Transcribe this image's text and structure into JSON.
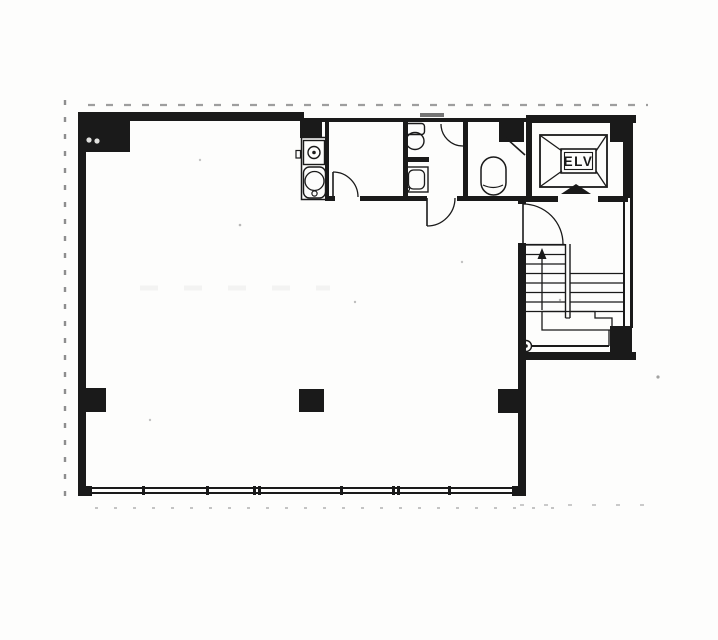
{
  "meta": {
    "ink": "#1a1a1a",
    "paper": "#fdfdfc",
    "description": "scanned-building-floor-plan"
  },
  "elevator": {
    "label": "ELV"
  },
  "plan": {
    "elements": [
      {
        "kind": "frect",
        "name": "wall-top-main",
        "x": 78,
        "y": 112,
        "w": 226,
        "h": 9
      },
      {
        "kind": "frect",
        "name": "wall-top-service",
        "x": 302,
        "y": 118,
        "w": 230,
        "h": 4
      },
      {
        "kind": "frect",
        "name": "window-mark-top",
        "x": 420,
        "y": 113,
        "w": 24,
        "h": 4,
        "opacity": 0.6
      },
      {
        "kind": "frect",
        "name": "wall-top-wing",
        "x": 526,
        "y": 115,
        "w": 110,
        "h": 8
      },
      {
        "kind": "frect",
        "name": "wall-left",
        "x": 78,
        "y": 112,
        "w": 8,
        "h": 384
      },
      {
        "kind": "frect",
        "name": "wall-east-main-stub",
        "x": 518,
        "y": 196,
        "w": 8,
        "h": 8
      },
      {
        "kind": "frect",
        "name": "wall-east-main",
        "x": 518,
        "y": 243,
        "w": 8,
        "h": 247
      },
      {
        "kind": "frect",
        "name": "wall-service-bottom-a",
        "x": 325,
        "y": 196,
        "w": 10,
        "h": 5
      },
      {
        "kind": "frect",
        "name": "wall-service-bottom-b",
        "x": 360,
        "y": 196,
        "w": 67,
        "h": 5
      },
      {
        "kind": "frect",
        "name": "wall-service-bottom-c",
        "x": 457,
        "y": 196,
        "w": 69,
        "h": 5
      },
      {
        "kind": "frect",
        "name": "wall-room1-west",
        "x": 325,
        "y": 120,
        "w": 4,
        "h": 78
      },
      {
        "kind": "frect",
        "name": "wall-room1-east",
        "x": 403,
        "y": 120,
        "w": 5,
        "h": 80
      },
      {
        "kind": "frect",
        "name": "wall-wc-divider",
        "x": 463,
        "y": 120,
        "w": 5,
        "h": 76
      },
      {
        "kind": "frect",
        "name": "wall-wc1-partition",
        "x": 403,
        "y": 157,
        "w": 26,
        "h": 5
      },
      {
        "kind": "frect",
        "name": "wall-wing-west",
        "x": 526,
        "y": 120,
        "w": 6,
        "h": 82
      },
      {
        "kind": "frect",
        "name": "wall-elv-bottom-west",
        "x": 526,
        "y": 196,
        "w": 32,
        "h": 6
      },
      {
        "kind": "frect",
        "name": "wall-elv-bottom-east",
        "x": 598,
        "y": 196,
        "w": 30,
        "h": 6
      },
      {
        "kind": "frect",
        "name": "wall-wing-east-upper",
        "x": 623,
        "y": 120,
        "w": 10,
        "h": 78
      },
      {
        "kind": "frect",
        "name": "wall-wing-east-line1",
        "x": 623,
        "y": 198,
        "w": 2,
        "h": 130
      },
      {
        "kind": "frect",
        "name": "wall-wing-east-line2",
        "x": 630,
        "y": 198,
        "w": 3,
        "h": 130
      },
      {
        "kind": "frect",
        "name": "wall-wing-bottom",
        "x": 518,
        "y": 352,
        "w": 118,
        "h": 8
      },
      {
        "kind": "frect",
        "name": "window-sill-top",
        "x": 86,
        "y": 487,
        "w": 432,
        "h": 2
      },
      {
        "kind": "frect",
        "name": "window-sill-bottom",
        "x": 86,
        "y": 492,
        "w": 432,
        "h": 2
      },
      {
        "kind": "frect",
        "name": "corner-block-sw",
        "x": 78,
        "y": 486,
        "w": 14,
        "h": 10
      },
      {
        "kind": "frect",
        "name": "corner-block-se",
        "x": 512,
        "y": 486,
        "w": 14,
        "h": 10
      },
      {
        "kind": "frect",
        "name": "column-nw",
        "x": 86,
        "y": 118,
        "w": 44,
        "h": 34
      },
      {
        "kind": "frect",
        "name": "column-n-kitchen",
        "x": 300,
        "y": 120,
        "w": 22,
        "h": 18
      },
      {
        "kind": "frect",
        "name": "column-n-wc",
        "x": 499,
        "y": 120,
        "w": 25,
        "h": 22
      },
      {
        "kind": "frect",
        "name": "column-ne",
        "x": 610,
        "y": 118,
        "w": 22,
        "h": 24
      },
      {
        "kind": "frect",
        "name": "column-west-wall",
        "x": 86,
        "y": 388,
        "w": 20,
        "h": 24
      },
      {
        "kind": "frect",
        "name": "column-center",
        "x": 299,
        "y": 389,
        "w": 25,
        "h": 23
      },
      {
        "kind": "frect",
        "name": "column-east-wall",
        "x": 498,
        "y": 389,
        "w": 20,
        "h": 24
      },
      {
        "kind": "frect",
        "name": "column-se-wing",
        "x": 610,
        "y": 326,
        "w": 22,
        "h": 28
      },
      {
        "kind": "frect",
        "name": "window-mullion-1",
        "x": 142,
        "y": 486,
        "w": 3,
        "h": 9
      },
      {
        "kind": "frect",
        "name": "window-mullion-2",
        "x": 206,
        "y": 486,
        "w": 3,
        "h": 9
      },
      {
        "kind": "frect",
        "name": "window-mullion-3",
        "x": 253,
        "y": 486,
        "w": 3,
        "h": 9
      },
      {
        "kind": "frect",
        "name": "window-mullion-4",
        "x": 258,
        "y": 486,
        "w": 3,
        "h": 9
      },
      {
        "kind": "frect",
        "name": "window-mullion-5",
        "x": 340,
        "y": 486,
        "w": 3,
        "h": 9
      },
      {
        "kind": "frect",
        "name": "window-mullion-6",
        "x": 392,
        "y": 486,
        "w": 3,
        "h": 9
      },
      {
        "kind": "frect",
        "name": "window-mullion-7",
        "x": 397,
        "y": 486,
        "w": 3,
        "h": 9
      },
      {
        "kind": "frect",
        "name": "window-mullion-8",
        "x": 448,
        "y": 486,
        "w": 3,
        "h": 9
      },
      {
        "kind": "srect",
        "name": "kitchen-unit-outline",
        "x": 301.5,
        "y": 137.5,
        "w": 25,
        "h": 62,
        "sw": 1.5
      },
      {
        "kind": "srect",
        "name": "kitchen-sink-top",
        "x": 303.5,
        "y": 140.5,
        "w": 21,
        "h": 24,
        "sw": 1.4
      },
      {
        "kind": "circle",
        "name": "kitchen-sink-drain",
        "cx": 314,
        "cy": 152.5,
        "r": 6,
        "sw": 1.4
      },
      {
        "kind": "fcircle",
        "name": "kitchen-sink-dot",
        "cx": 314,
        "cy": 152.5,
        "r": 1.8
      },
      {
        "kind": "srect",
        "name": "kitchen-basin-outline",
        "x": 303.5,
        "y": 167,
        "w": 22,
        "h": 31,
        "rx": 6,
        "sw": 1.4
      },
      {
        "kind": "circle",
        "name": "kitchen-basin-bowl",
        "cx": 314.5,
        "cy": 181,
        "r": 9.5,
        "sw": 1.3
      },
      {
        "kind": "circle",
        "name": "kitchen-basin-drain",
        "cx": 314.5,
        "cy": 193.5,
        "r": 2.6,
        "sw": 1.2
      },
      {
        "kind": "srect",
        "name": "kitchen-knob",
        "x": 296,
        "y": 150.5,
        "w": 4.5,
        "h": 7.5,
        "sw": 1.2
      },
      {
        "kind": "path",
        "name": "room1-door-leaf",
        "d": "M333,172 L333,197",
        "sw": 1.6
      },
      {
        "kind": "path",
        "name": "room1-door-swing",
        "d": "M333,172 A25,25 0 0 1 358,197",
        "sw": 1.3
      },
      {
        "kind": "srect",
        "name": "wc1-toilet-tank",
        "x": 405.5,
        "y": 123.5,
        "w": 19,
        "h": 11,
        "rx": 3,
        "sw": 1.4
      },
      {
        "kind": "ellipse",
        "name": "wc1-toilet-bowl",
        "cx": 415,
        "cy": 141,
        "rx": 9,
        "ry": 8.5,
        "sw": 1.4
      },
      {
        "kind": "path",
        "name": "wc1-stall-door-swing",
        "d": "M441,124 A22,22 0 0 0 463,146",
        "sw": 1.3
      },
      {
        "kind": "srect",
        "name": "wc1-sink-outline",
        "x": 405,
        "y": 167,
        "w": 23,
        "h": 25,
        "sw": 1.4
      },
      {
        "kind": "srect",
        "name": "wc1-sink-basin",
        "x": 408.5,
        "y": 170,
        "w": 16,
        "h": 19,
        "rx": 5,
        "sw": 1.3
      },
      {
        "kind": "circle",
        "name": "wc1-sink-tap",
        "cx": 407.5,
        "cy": 189,
        "r": 2,
        "sw": 1.2
      },
      {
        "kind": "path",
        "name": "wc1-entry-door-leaf",
        "d": "M427,198 L427,226",
        "sw": 1.6
      },
      {
        "kind": "path",
        "name": "wc1-entry-door-swing",
        "d": "M427,226 A28,28 0 0 0 455,198",
        "sw": 1.3
      },
      {
        "kind": "srect",
        "name": "wc2-toilet",
        "x": 481,
        "y": 157,
        "w": 25,
        "h": 38,
        "rx": 12.5,
        "sw": 1.5
      },
      {
        "kind": "path",
        "name": "wc2-toilet-seatline",
        "d": "M483,185 Q493.5,190 503,185",
        "sw": 1.2
      },
      {
        "kind": "path",
        "name": "wc2-door-leaf",
        "d": "M506,138 L525,155",
        "sw": 1.6
      },
      {
        "kind": "srect",
        "name": "elevator-shaft",
        "x": 540,
        "y": 135,
        "w": 67,
        "h": 52,
        "sw": 1.8
      },
      {
        "kind": "path",
        "name": "elevator-cross-nw",
        "d": "M541,136 L562,151",
        "sw": 1.3
      },
      {
        "kind": "path",
        "name": "elevator-cross-ne",
        "d": "M606,136 L596,151",
        "sw": 1.3
      },
      {
        "kind": "path",
        "name": "elevator-cross-sw",
        "d": "M541,186 L562,171",
        "sw": 1.3
      },
      {
        "kind": "path",
        "name": "elevator-cross-se",
        "d": "M606,186 L596,171",
        "sw": 1.3
      },
      {
        "kind": "srect",
        "name": "elevator-label-box-outer",
        "x": 561,
        "y": 149,
        "w": 35,
        "h": 24,
        "sw": 1.6
      },
      {
        "kind": "srect",
        "name": "elevator-label-box-inner",
        "x": 564.5,
        "y": 152.5,
        "w": 28,
        "h": 17,
        "sw": 1.1
      },
      {
        "kind": "poly",
        "name": "elevator-door-marker",
        "points": "576,184 591,194 561,194"
      },
      {
        "kind": "path",
        "name": "hall-door-leaf",
        "d": "M523,204 L523,244",
        "sw": 1.6
      },
      {
        "kind": "path",
        "name": "hall-door-swing",
        "d": "M523,204 A40,40 0 0 1 563,244",
        "sw": 1.3
      },
      {
        "kind": "line",
        "name": "stair-tread-hall",
        "x1": 523,
        "y1": 244.5,
        "x2": 565,
        "y2": 244.5,
        "sw": 1.2
      },
      {
        "kind": "line",
        "name": "stair-tread-l1",
        "x1": 526,
        "y1": 245,
        "x2": 565,
        "y2": 245,
        "sw": 1.2
      },
      {
        "kind": "line",
        "name": "stair-tread-l2",
        "x1": 526,
        "y1": 254.5,
        "x2": 565,
        "y2": 254.5,
        "sw": 1.2
      },
      {
        "kind": "line",
        "name": "stair-tread-l3",
        "x1": 526,
        "y1": 264,
        "x2": 565,
        "y2": 264,
        "sw": 1.2
      },
      {
        "kind": "line",
        "name": "stair-tread-l4",
        "x1": 526,
        "y1": 273.5,
        "x2": 565,
        "y2": 273.5,
        "sw": 1.2
      },
      {
        "kind": "line",
        "name": "stair-tread-l5",
        "x1": 526,
        "y1": 283,
        "x2": 565,
        "y2": 283,
        "sw": 1.2
      },
      {
        "kind": "line",
        "name": "stair-tread-l6",
        "x1": 526,
        "y1": 292.5,
        "x2": 565,
        "y2": 292.5,
        "sw": 1.2
      },
      {
        "kind": "line",
        "name": "stair-tread-l7",
        "x1": 526,
        "y1": 302,
        "x2": 565,
        "y2": 302,
        "sw": 1.2
      },
      {
        "kind": "line",
        "name": "stair-tread-l8",
        "x1": 526,
        "y1": 311.5,
        "x2": 565,
        "y2": 311.5,
        "sw": 1.2
      },
      {
        "kind": "line",
        "name": "stair-tread-r1",
        "x1": 570,
        "y1": 273.5,
        "x2": 623,
        "y2": 273.5,
        "sw": 1.2
      },
      {
        "kind": "line",
        "name": "stair-tread-r2",
        "x1": 570,
        "y1": 283,
        "x2": 623,
        "y2": 283,
        "sw": 1.2
      },
      {
        "kind": "line",
        "name": "stair-tread-r3",
        "x1": 570,
        "y1": 292.5,
        "x2": 623,
        "y2": 292.5,
        "sw": 1.2
      },
      {
        "kind": "line",
        "name": "stair-tread-r4",
        "x1": 570,
        "y1": 302,
        "x2": 623,
        "y2": 302,
        "sw": 1.2
      },
      {
        "kind": "line",
        "name": "stair-tread-r5",
        "x1": 570,
        "y1": 311.5,
        "x2": 623,
        "y2": 311.5,
        "sw": 1.2
      },
      {
        "kind": "line",
        "name": "stair-divider-left",
        "x1": 565.5,
        "y1": 244,
        "x2": 565.5,
        "y2": 318,
        "sw": 1.4
      },
      {
        "kind": "line",
        "name": "stair-divider-right",
        "x1": 570,
        "y1": 244,
        "x2": 570,
        "y2": 318,
        "sw": 1.4
      },
      {
        "kind": "line",
        "name": "stair-divider-cap",
        "x1": 565.5,
        "y1": 318,
        "x2": 570,
        "y2": 318,
        "sw": 1.2
      },
      {
        "kind": "line",
        "name": "stair-direction-line",
        "x1": 542,
        "y1": 258,
        "x2": 542,
        "y2": 310,
        "sw": 1.3
      },
      {
        "kind": "poly",
        "name": "stair-direction-arrow",
        "points": "542,248 537.5,259 546.5,259"
      },
      {
        "kind": "path",
        "name": "stair-landing-outline",
        "d": "M542,311.5 L595,311.5 L595,318 L612,318 L612,330 L542,330 Z",
        "sw": 1.3
      },
      {
        "kind": "line",
        "name": "stair-handrail-line",
        "x1": 531,
        "y1": 346,
        "x2": 609,
        "y2": 346,
        "sw": 2
      },
      {
        "kind": "line",
        "name": "stair-landing-step",
        "x1": 609,
        "y1": 330,
        "x2": 609,
        "y2": 346,
        "sw": 1.3
      },
      {
        "kind": "circle",
        "name": "stair-newel-circle",
        "cx": 526,
        "cy": 346,
        "r": 5.5,
        "sw": 1.4
      },
      {
        "kind": "fcircle",
        "name": "stair-newel-dot",
        "cx": 526,
        "cy": 346,
        "r": 1.8
      },
      {
        "kind": "line",
        "name": "scan-artifact-top",
        "x1": 88,
        "y1": 105,
        "x2": 648,
        "y2": 105,
        "sw": 2.2,
        "dash": "7 11",
        "opacity": 0.5,
        "color": "#3f3f3f"
      },
      {
        "kind": "line",
        "name": "scan-artifact-left",
        "x1": 65,
        "y1": 100,
        "x2": 65,
        "y2": 505,
        "sw": 2.4,
        "dash": "5 12",
        "opacity": 0.55,
        "color": "#333333"
      },
      {
        "kind": "line",
        "name": "scan-artifact-bottom",
        "x1": 95,
        "y1": 508,
        "x2": 560,
        "y2": 508,
        "sw": 2,
        "dash": "3 16",
        "opacity": 0.28,
        "color": "#333333"
      },
      {
        "kind": "line",
        "name": "scan-artifact-bottom-right",
        "x1": 520,
        "y1": 505,
        "x2": 645,
        "y2": 505,
        "sw": 2,
        "dash": "4 20",
        "opacity": 0.25,
        "color": "#333333"
      },
      {
        "kind": "line",
        "name": "scan-smudge-room",
        "x1": 140,
        "y1": 288,
        "x2": 330,
        "y2": 288,
        "sw": 5,
        "dash": "18 26",
        "opacity": 0.06,
        "color": "#555555"
      },
      {
        "kind": "fcircle",
        "name": "scan-speck-1",
        "cx": 240,
        "cy": 225,
        "r": 1.3,
        "opacity": 0.3
      },
      {
        "kind": "fcircle",
        "name": "scan-speck-2",
        "cx": 355,
        "cy": 302,
        "r": 1.2,
        "opacity": 0.28
      },
      {
        "kind": "fcircle",
        "name": "scan-speck-3",
        "cx": 150,
        "cy": 420,
        "r": 1.2,
        "opacity": 0.26
      },
      {
        "kind": "fcircle",
        "name": "scan-speck-4",
        "cx": 462,
        "cy": 262,
        "r": 1.2,
        "opacity": 0.26
      },
      {
        "kind": "fcircle",
        "name": "scan-speck-5",
        "cx": 560,
        "cy": 300,
        "r": 1.2,
        "opacity": 0.3
      },
      {
        "kind": "fcircle",
        "name": "scan-speck-6",
        "cx": 200,
        "cy": 160,
        "r": 1.2,
        "opacity": 0.25
      },
      {
        "kind": "fcircle",
        "name": "scan-speck-7",
        "cx": 658,
        "cy": 377,
        "r": 1.6,
        "opacity": 0.4
      },
      {
        "kind": "fcircle",
        "name": "scan-white-mark-1",
        "cx": 89,
        "cy": 140,
        "r": 2.6,
        "color": "#f6f6f4",
        "opacity": 0.9
      },
      {
        "kind": "fcircle",
        "name": "scan-white-mark-2",
        "cx": 97,
        "cy": 141,
        "r": 2.6,
        "color": "#f6f6f4",
        "opacity": 0.9
      }
    ]
  }
}
